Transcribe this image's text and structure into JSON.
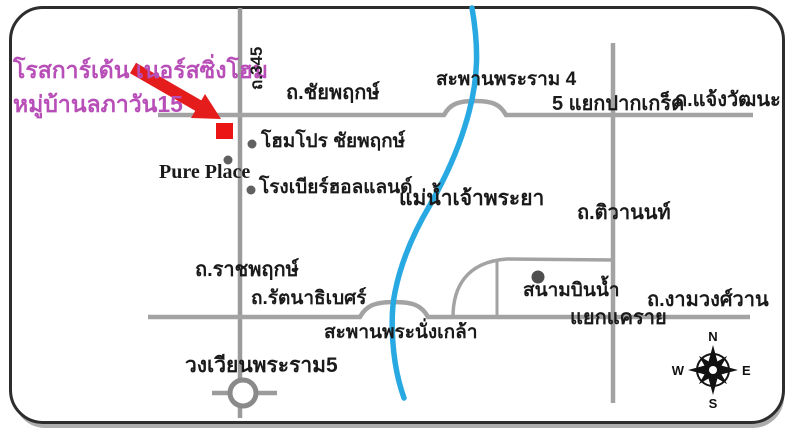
{
  "legend": {
    "title_line1": "โรสการ์เด้น เนอร์สซิ่งโฮม",
    "title_line2": "หมู่บ้านลภาวัน15"
  },
  "roads": {
    "route_345": "ถ.345",
    "chaiyaphruek": "ถ.ชัยพฤกษ์",
    "chaengwattana": "ถ.แจ้งวัฒนะ",
    "tiwanon": "ถ.ติวานนท์",
    "ratchaphruek": "ถ.ราชพฤกษ์",
    "rattanathibet": "ถ.รัตนาธิเบศร์",
    "ngamwongwan": "ถ.งามวงศ์วาน"
  },
  "bridges": {
    "rama4": "สะพานพระราม 4",
    "phra_nangklao": "สะพานพระนั่งเกล้า"
  },
  "junctions": {
    "pakkret": "5 แยกปากเกร็ด",
    "khae_rai": "แยกแคราย",
    "rama5_roundabout": "วงเวียนพระราม5"
  },
  "places": {
    "homepro": "โฮมโปร ชัยพฤกษ์",
    "pure_place": "Pure Place",
    "holland_brewery": "โรงเบียร์ฮอลแลนด์",
    "sanambinnam": "สนามบินน้ำ"
  },
  "river": {
    "name": "แม่น้ำเจ้าพระยา"
  },
  "compass": {
    "north": "N",
    "south": "S",
    "east": "E",
    "west": "W"
  },
  "colors": {
    "destination_red": "#e41c1c",
    "title_magenta": "#b84fb8",
    "river_blue": "#29a9e1",
    "road_gray": "#a3a3a3",
    "label_black": "#1a1a1a"
  }
}
